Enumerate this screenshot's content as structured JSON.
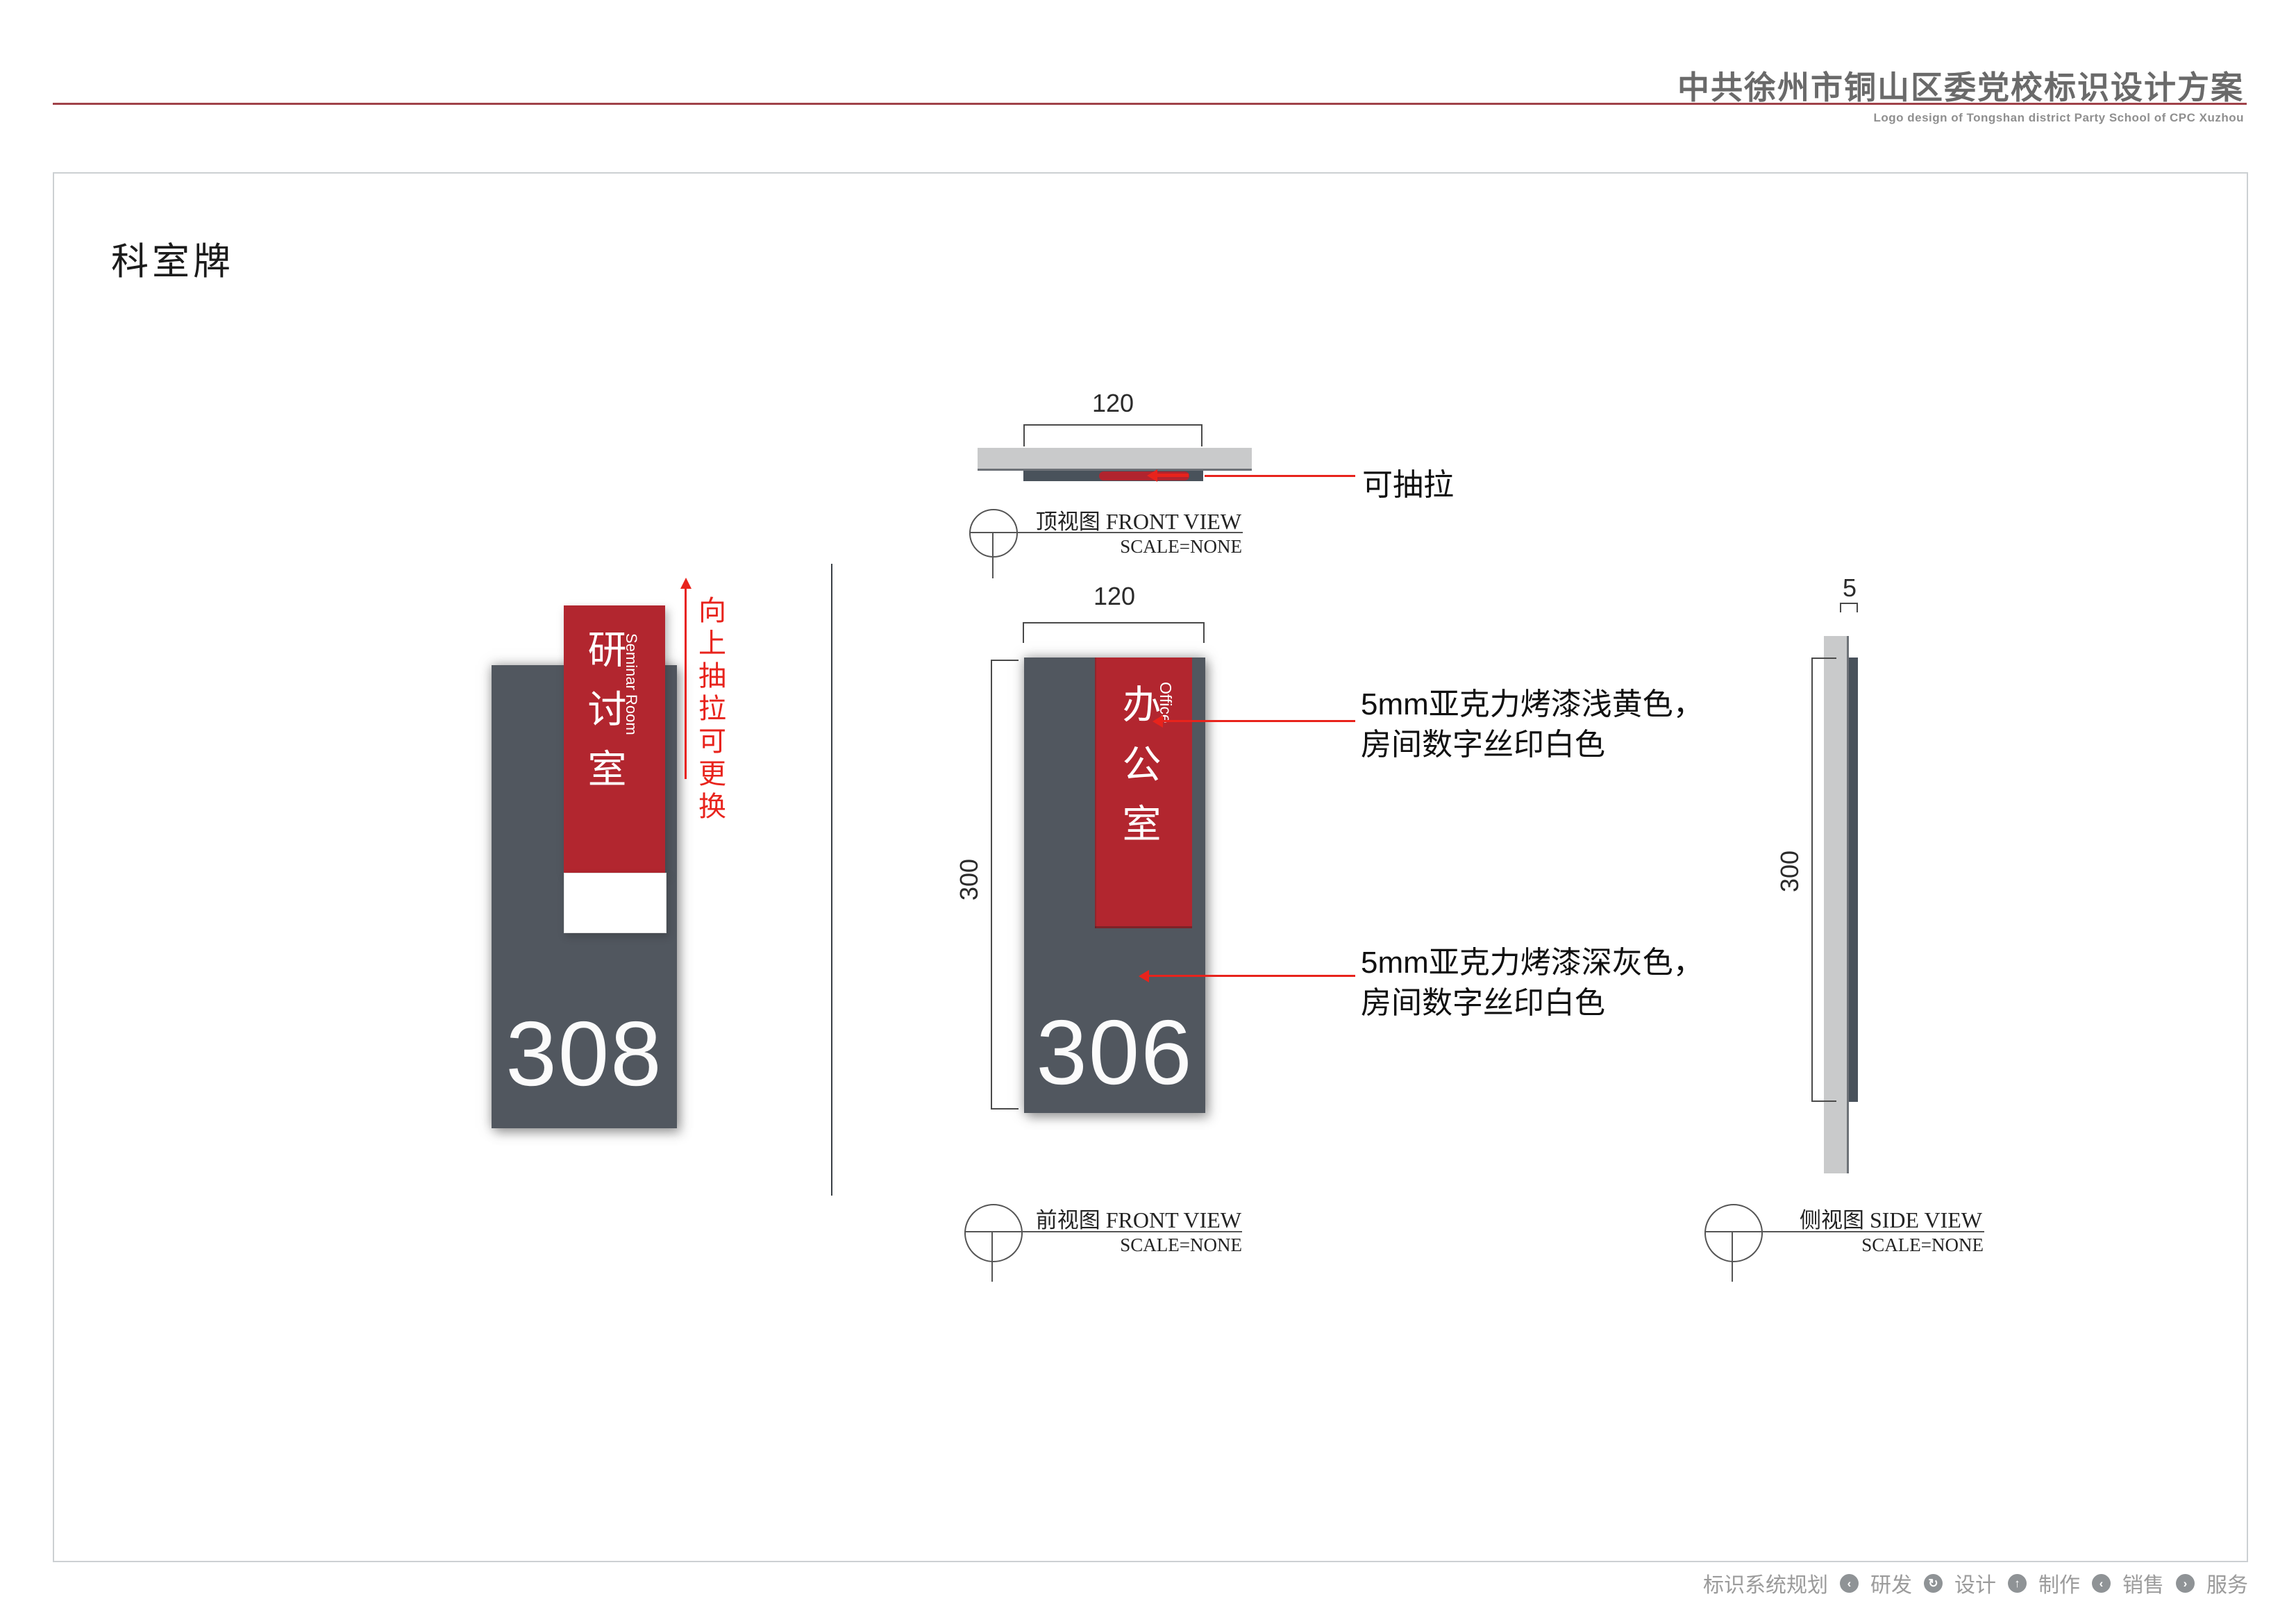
{
  "header": {
    "title": "中共徐州市铜山区委党校标识设计方案",
    "subtitle": "Logo design of Tongshan district Party School of CPC Xuzhou"
  },
  "section_title": "科室牌",
  "colors": {
    "panel_gray": "#51575f",
    "insert_red": "#b2262f",
    "annotation_red": "#e8231c",
    "rail_light_gray": "#c9cacb",
    "top_bar_dark": "#49525b",
    "header_rule_red": "#a04249"
  },
  "left_sign": {
    "room_name": "研讨室",
    "room_name_en": "Seminar Room",
    "room_number": "308",
    "annotation": "向上抽拉可更换"
  },
  "top_view": {
    "dim_width": "120",
    "pull_label": "可抽拉",
    "title_cn": "顶视图",
    "title_en": " FRONT VIEW",
    "scale": "SCALE=NONE"
  },
  "front_view": {
    "dim_width": "120",
    "dim_height": "300",
    "room_name": "办公室",
    "room_name_en": "Office",
    "room_number": "306",
    "callout_top_line1": "5mm亚克力烤漆浅黄色，",
    "callout_top_line2": "房间数字丝印白色",
    "callout_bottom_line1": "5mm亚克力烤漆深灰色，",
    "callout_bottom_line2": "房间数字丝印白色",
    "title_cn": "前视图",
    "title_en": " FRONT VIEW",
    "scale": "SCALE=NONE"
  },
  "side_view": {
    "dim_thickness": "5",
    "dim_height": "300",
    "title_cn": "侧视图",
    "title_en": " SIDE VIEW",
    "scale": "SCALE=NONE"
  },
  "footer": {
    "items": [
      "标识系统规划",
      "研发",
      "设计",
      "制作",
      "销售",
      "服务"
    ],
    "icon_glyphs": [
      "‹",
      "↻",
      "↑",
      "‹",
      "›"
    ]
  }
}
